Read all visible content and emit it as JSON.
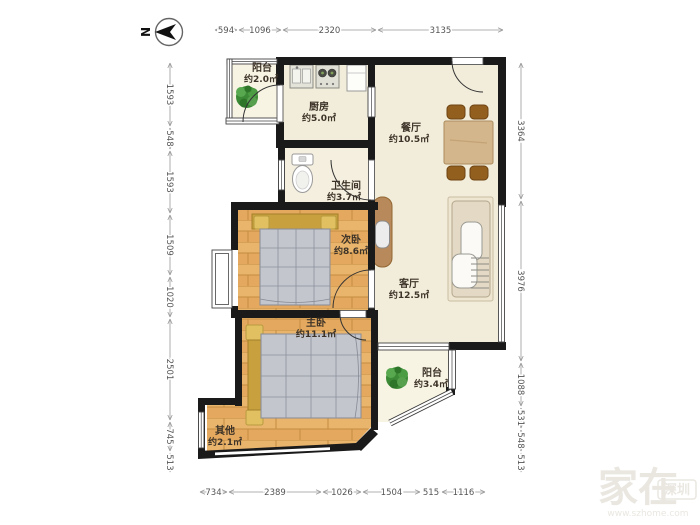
{
  "compass": {
    "label": "N"
  },
  "rooms": [
    {
      "id": "balcony-north",
      "name": "阳台",
      "area": "约2.0㎡"
    },
    {
      "id": "kitchen",
      "name": "厨房",
      "area": "约5.0㎡"
    },
    {
      "id": "dining",
      "name": "餐厅",
      "area": "约10.5㎡"
    },
    {
      "id": "bathroom",
      "name": "卫生间",
      "area": "约3.7㎡"
    },
    {
      "id": "bedroom-second",
      "name": "次卧",
      "area": "约8.6㎡"
    },
    {
      "id": "living",
      "name": "客厅",
      "area": "约12.5㎡"
    },
    {
      "id": "bedroom-master",
      "name": "主卧",
      "area": "约11.1㎡"
    },
    {
      "id": "other",
      "name": "其他",
      "area": "约2.1㎡"
    },
    {
      "id": "balcony-south",
      "name": "阳台",
      "area": "约3.4㎡"
    }
  ],
  "dims": {
    "top": [
      "594",
      "1096",
      "2320",
      "3135"
    ],
    "bottom": [
      "734",
      "2389",
      "1026",
      "1504",
      "515",
      "1116"
    ],
    "left": [
      "1593",
      "548",
      "1593",
      "1509",
      "1020",
      "2501",
      "745",
      "513"
    ],
    "right": [
      "3364",
      "3976",
      "1088",
      "531",
      "548",
      "513"
    ]
  },
  "watermark": {
    "brand": "家在",
    "city": "深圳",
    "url": "www.szhome.com"
  },
  "colors": {
    "wall": "#1a1a1a",
    "wood_floor": "#e4a95e",
    "tile_floor": "#f3eeda",
    "accent_bed": "#c8a13e",
    "plant": "#3c8a36"
  }
}
